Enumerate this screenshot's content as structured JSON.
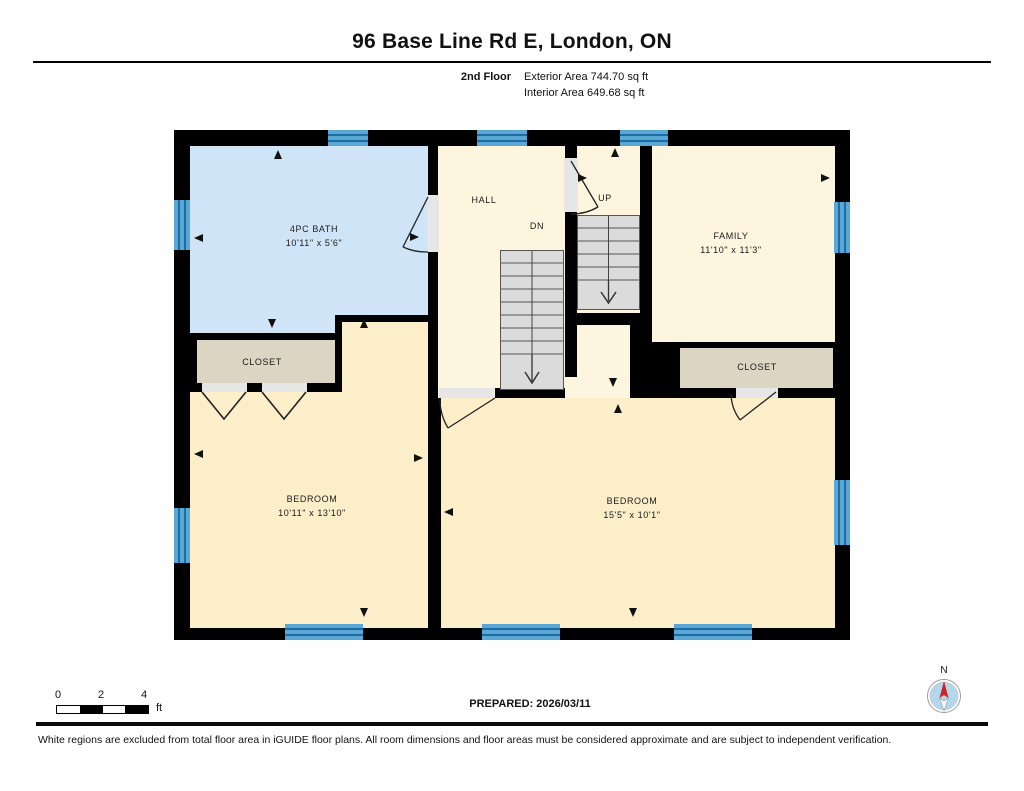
{
  "header": {
    "title": "96 Base Line Rd E, London, ON",
    "floor_label": "2nd Floor",
    "exterior_area": "Exterior Area 744.70 sq ft",
    "interior_area": "Interior Area 649.68 sq ft"
  },
  "plan": {
    "rooms": {
      "bath": {
        "name": "4PC BATH",
        "dims": "10'11\" x 5'6\""
      },
      "hall": {
        "name": "HALL"
      },
      "family": {
        "name": "FAMILY",
        "dims": "11'10\" x 11'3\""
      },
      "bedroom_left": {
        "name": "BEDROOM",
        "dims": "10'11\" x 13'10\""
      },
      "bedroom_right": {
        "name": "BEDROOM",
        "dims": "15'5\" x 10'1\""
      },
      "closet_left": {
        "name": "CLOSET"
      },
      "closet_right": {
        "name": "CLOSET"
      }
    },
    "stairs": {
      "up_label": "UP",
      "down_label": "DN"
    }
  },
  "footer": {
    "scale_ticks": [
      "0",
      "2",
      "4"
    ],
    "scale_unit": "ft",
    "prepared": "PREPARED: 2026/03/11",
    "compass_label": "N",
    "disclaimer": "White regions are excluded from total floor area in iGUIDE floor plans. All room dimensions and floor areas must be considered approximate and are subject to independent verification."
  },
  "colors": {
    "wall": "#000000",
    "bath": "#cfe5f7",
    "room": "#fdf5dd",
    "bedroom": "#fbeec9",
    "closet": "#dcd5c3",
    "window": "#5aa7d6",
    "window_line": "#1d6da5",
    "stairs": "#dbdbdb",
    "door": "#e6e6e6",
    "compass_red": "#cc2222",
    "compass_fill": "#b5d7ed"
  }
}
